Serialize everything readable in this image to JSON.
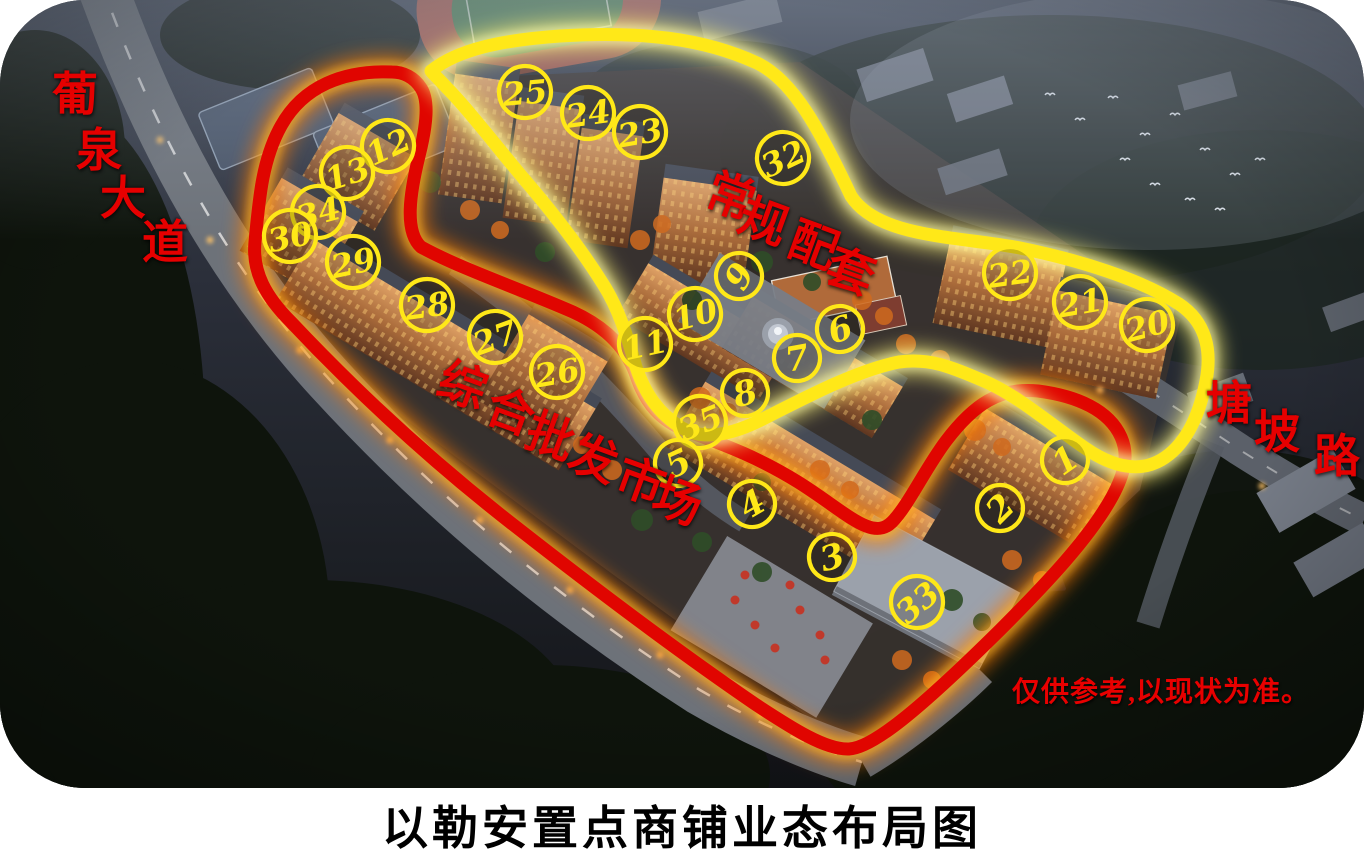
{
  "title": "以勒安置点商铺业态布局图",
  "disclaimer": "仅供参考,以现状为准。",
  "roads": {
    "puquan": {
      "name": "葡泉大道",
      "chars": [
        "葡",
        "泉",
        "大",
        "道"
      ]
    },
    "tangpo": {
      "name": "塘坡路",
      "chars": [
        "塘",
        "坡",
        "路"
      ]
    }
  },
  "zones": {
    "market": {
      "name": "综合批发市场",
      "chars": [
        "综",
        "合",
        "批",
        "发",
        "市",
        "场"
      ],
      "outline_color": "#e00500"
    },
    "facilities": {
      "name": "常规配套",
      "chars": [
        "常",
        "规",
        "配",
        "套"
      ],
      "outline_color": "#ffe818"
    }
  },
  "colors": {
    "route_red": "#e00500",
    "route_yellow": "#ffe818",
    "marker_ring": "#ffe818",
    "marker_text": "#ffe818",
    "label_red": "#e60000",
    "title_color": "#000000"
  },
  "markers": [
    {
      "label": "25",
      "x": 525,
      "y": 92,
      "rot": -5
    },
    {
      "label": "24",
      "x": 588,
      "y": 113,
      "rot": -8
    },
    {
      "label": "23",
      "x": 640,
      "y": 132,
      "rot": -10
    },
    {
      "label": "32",
      "x": 783,
      "y": 158,
      "rot": -25
    },
    {
      "label": "12",
      "x": 388,
      "y": 146,
      "rot": -25
    },
    {
      "label": "13",
      "x": 347,
      "y": 173,
      "rot": -18
    },
    {
      "label": "34",
      "x": 318,
      "y": 212,
      "rot": -15
    },
    {
      "label": "30",
      "x": 290,
      "y": 236,
      "rot": -12
    },
    {
      "label": "29",
      "x": 353,
      "y": 262,
      "rot": -12
    },
    {
      "label": "28",
      "x": 427,
      "y": 305,
      "rot": -8
    },
    {
      "label": "27",
      "x": 495,
      "y": 337,
      "rot": -20
    },
    {
      "label": "26",
      "x": 557,
      "y": 372,
      "rot": -10
    },
    {
      "label": "9",
      "x": 739,
      "y": 276,
      "rot": -60
    },
    {
      "label": "10",
      "x": 695,
      "y": 314,
      "rot": -15
    },
    {
      "label": "11",
      "x": 645,
      "y": 344,
      "rot": -12
    },
    {
      "label": "6",
      "x": 840,
      "y": 329,
      "rot": -18
    },
    {
      "label": "7",
      "x": 797,
      "y": 358,
      "rot": -10
    },
    {
      "label": "8",
      "x": 745,
      "y": 393,
      "rot": -15
    },
    {
      "label": "35",
      "x": 700,
      "y": 422,
      "rot": -22
    },
    {
      "label": "22",
      "x": 1010,
      "y": 273,
      "rot": -8
    },
    {
      "label": "21",
      "x": 1080,
      "y": 302,
      "rot": -10
    },
    {
      "label": "20",
      "x": 1147,
      "y": 325,
      "rot": -15
    },
    {
      "label": "5",
      "x": 678,
      "y": 463,
      "rot": -25
    },
    {
      "label": "4",
      "x": 752,
      "y": 504,
      "rot": -30
    },
    {
      "label": "3",
      "x": 832,
      "y": 557,
      "rot": -15
    },
    {
      "label": "33",
      "x": 917,
      "y": 602,
      "rot": -40
    },
    {
      "label": "2",
      "x": 1000,
      "y": 508,
      "rot": -45
    },
    {
      "label": "1",
      "x": 1065,
      "y": 460,
      "rot": -35
    }
  ]
}
